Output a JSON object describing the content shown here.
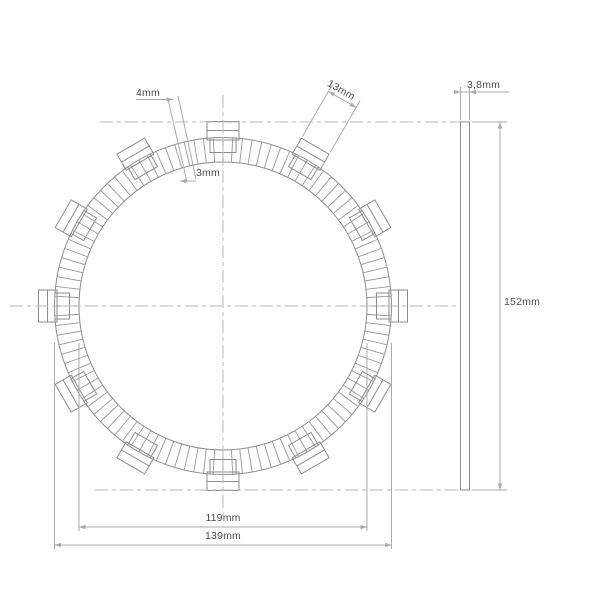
{
  "page": {
    "background_color": "#ffffff"
  },
  "drawing": {
    "type": "technical-drawing",
    "subject": "clutch friction disc - front view with friction pad segments and outer drive tabs, plus side thickness view",
    "colors": {
      "outline": "#8d8d8d",
      "segment_lines": "#989898",
      "dimension_lines": "#ababab",
      "centerlines": "#b9b9b9",
      "label_text": "#4d4d4d"
    },
    "dimensions": {
      "pad_width_outer": "4mm",
      "pad_width_inner": "3mm",
      "tab_width": "13mm",
      "plate_thickness": "3,8mm",
      "overall_diameter": "152mm",
      "inner_diameter": "119mm",
      "friction_ring_outer_diameter": "139mm"
    },
    "geometry": {
      "center": {
        "x": 223,
        "y": 306
      },
      "radius_outer": 168.5,
      "radius_inner": 144,
      "radius_tab_outer": 184.5,
      "tab_count": 12,
      "tab_angle_step_deg": 30,
      "tab_flange_width": 32,
      "tab_flange_inner_radius": 166,
      "tab_chamfer_radius": 175.5,
      "tab_neck_width": 26,
      "tab_neck_inner_radius": 153.5,
      "segment_line_count": 108,
      "side_view": {
        "x": 460.5,
        "y": 122,
        "width": 9,
        "height": 368
      }
    }
  }
}
